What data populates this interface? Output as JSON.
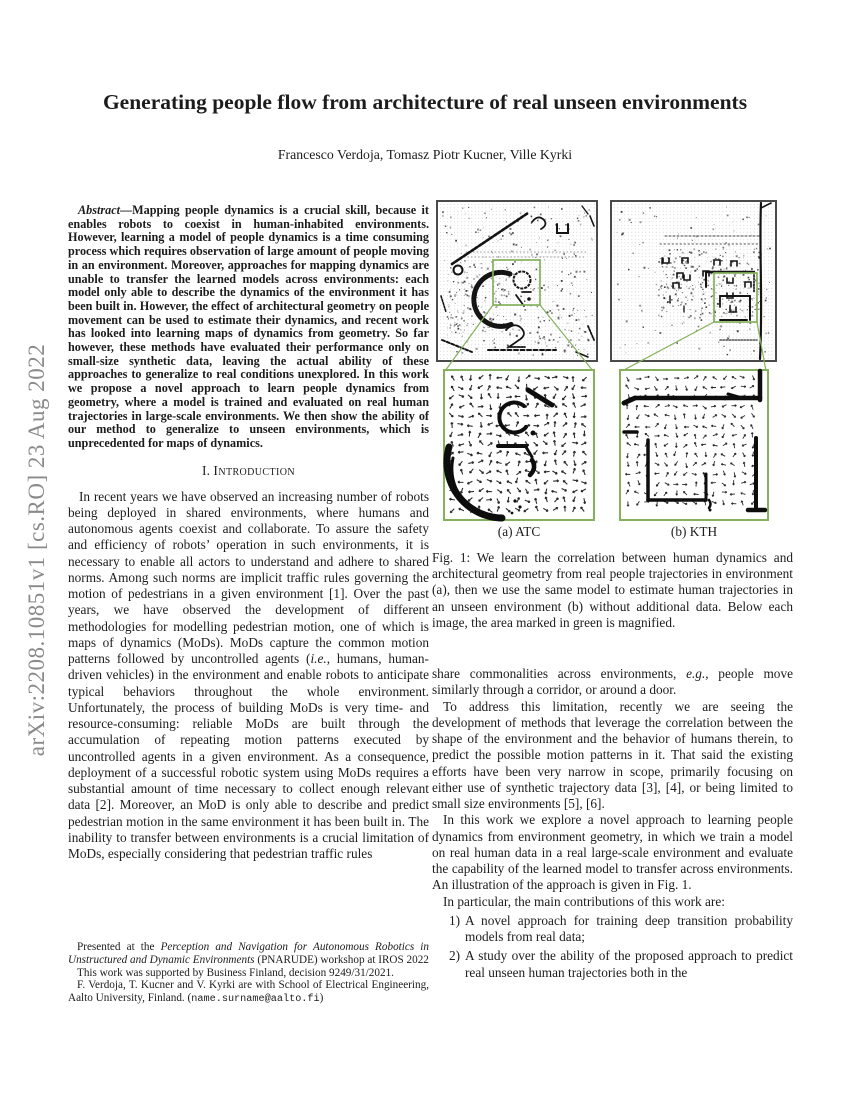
{
  "watermark": "arXiv:2208.10851v1  [cs.RO]  23 Aug 2022",
  "title": "Generating people flow from architecture of real unseen environments",
  "authors": "Francesco Verdoja, Tomasz Piotr Kucner, Ville Kyrki",
  "abstract": {
    "spans": [
      {
        "t": "Abstract",
        "s": "bi"
      },
      {
        "t": "—Mapping people dynamics is a crucial skill, because it enables robots to coexist in human-inhabited environments. However, learning a model of people dynamics is a time consuming process which requires observation of large amount of people moving in an environment. Moreover, approaches for mapping dynamics are unable to transfer the learned models across environments: each model only able to describe the dynamics of the environment it has been built in. However, the effect of architectural geometry on people movement can be used to estimate their dynamics, and recent work has looked into learning maps of dynamics from geometry. So far however, these methods have evaluated their performance only on small-size synthetic data, leaving the actual ability of these approaches to generalize to real conditions unexplored. In this work we propose a novel approach to learn people dynamics from geometry, where a model is trained and evaluated on real human trajectories in large-scale environments. We then show the ability of our method to generalize to unseen environments, which is unprecedented for maps of dynamics.",
        "s": "b"
      }
    ]
  },
  "section1": {
    "label": "I.",
    "title": "Introduction"
  },
  "intro": {
    "p1": [
      {
        "t": "In recent years we have observed an increasing number of robots being deployed in shared environments, where humans and autonomous agents coexist and collaborate. To assure the safety and efficiency of robots’ operation in such environments, it is necessary to enable all actors to understand and adhere to shared norms. Among such norms are implicit traffic rules governing the motion of pedestrians in a given environment [1]. Over the past years, we have observed the development of different methodologies for modelling pedestrian motion, one of which is maps of dynamics (MoDs). MoDs capture the common motion patterns followed by uncontrolled agents (",
        "s": ""
      },
      {
        "t": "i.e.",
        "s": "i"
      },
      {
        "t": ", humans, human-driven vehicles) in the environment and enable robots to anticipate typical behaviors throughout the whole environment. Unfortunately, the process of building MoDs is very time- and resource-consuming: reliable MoDs are built through the accumulation of repeating motion patterns executed by uncontrolled agents in a given environment. As a consequence, deployment of a successful robotic system using MoDs requires a substantial amount of time necessary to collect enough relevant data [2]. Moreover, an MoD is only able to describe and predict pedestrian motion in the same environment it has been built in. The inability to transfer between environments is a crucial limitation of MoDs, especially considering that pedestrian traffic rules",
        "s": ""
      }
    ]
  },
  "footnote": {
    "p1": [
      {
        "t": "Presented at the ",
        "s": ""
      },
      {
        "t": "Perception and Navigation for Autonomous Robotics in Unstructured and Dynamic Environments",
        "s": "i"
      },
      {
        "t": " (PNARUDE) workshop at IROS 2022",
        "s": ""
      }
    ],
    "p2": [
      {
        "t": "This work was supported by Business Finland, decision 9249/31/2021.",
        "s": ""
      }
    ],
    "p3": [
      {
        "t": "F. Verdoja, T. Kucner and V. Kyrki are with School of Electrical Engineering, Aalto University, Finland. (",
        "s": ""
      },
      {
        "t": "name.surname@aalto.fi",
        "s": "tt"
      },
      {
        "t": ")",
        "s": ""
      }
    ]
  },
  "figure": {
    "subcaption_a": "(a) ATC",
    "subcaption_b": "(b) KTH",
    "caption": "Fig. 1: We learn the correlation between human dynamics and architectural geometry from real people trajectories in environment (a), then we use the same model to estimate human trajectories in an unseen environment (b) without additional data. Below each image, the area marked in green is magnified.",
    "highlight_color": "#85b15d",
    "map_border_color": "#4a4a4a",
    "ink_color": "#141414"
  },
  "col2": {
    "p1": [
      {
        "t": "share commonalities across environments, ",
        "s": ""
      },
      {
        "t": "e.g.",
        "s": "i"
      },
      {
        "t": ", people move similarly through a corridor, or around a door.",
        "s": ""
      }
    ],
    "p2": "To address this limitation, recently we are seeing the development of methods that leverage the correlation between the shape of the environment and the behavior of humans therein, to predict the possible motion patterns in it. That said the existing efforts have been very narrow in scope, primarily focusing on either use of synthetic trajectory data [3], [4], or being limited to small size environments [5], [6].",
    "p3": "In this work we explore a novel approach to learning people dynamics from environment geometry, in which we train a model on real human data in a real large-scale environment and evaluate the capability of the learned model to transfer across environments. An illustration of the approach is given in Fig. 1.",
    "p4": "In particular, the main contributions of this work are:",
    "items": [
      {
        "num": "1)",
        "text": "A novel approach for training deep transition probability models from real data;"
      },
      {
        "num": "2)",
        "text": "A study over the ability of the proposed approach to predict real unseen human trajectories both in the"
      }
    ]
  }
}
